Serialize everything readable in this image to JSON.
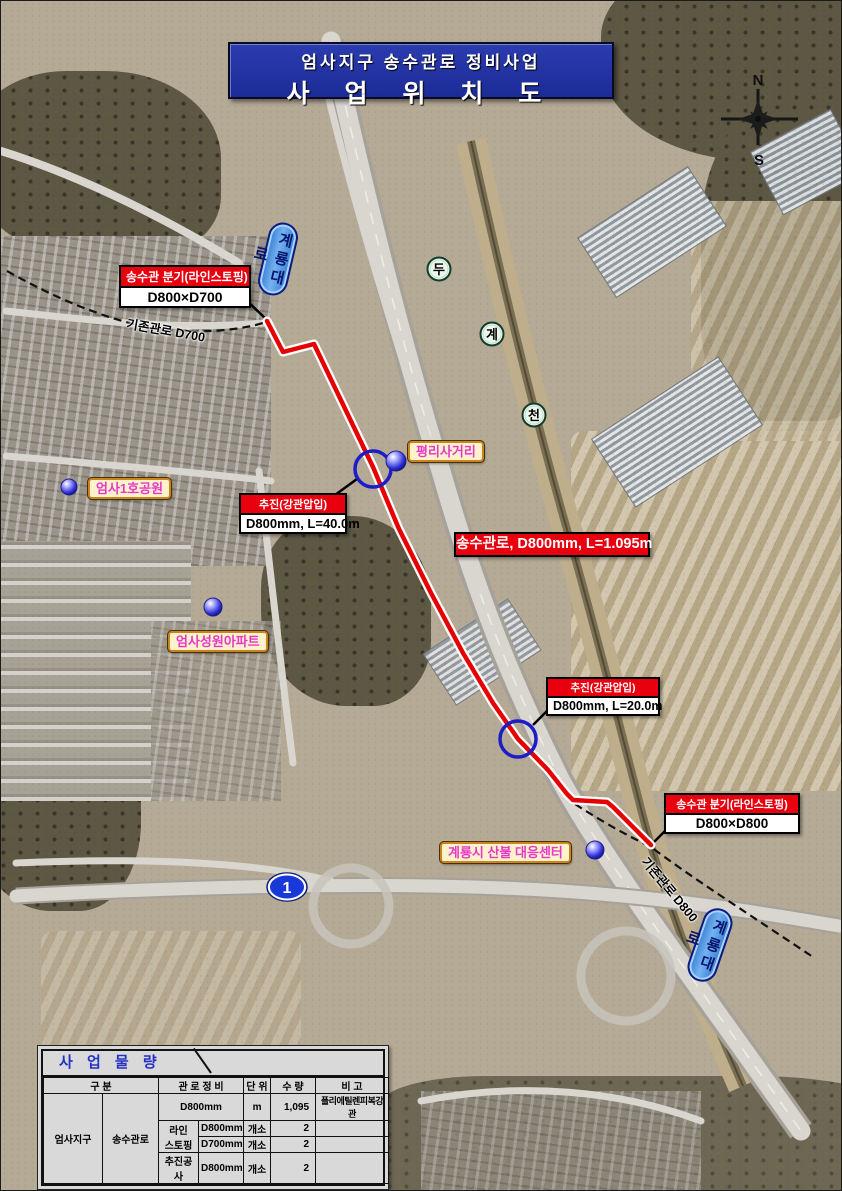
{
  "colors": {
    "title_bg": "#1c2b96",
    "callout_header_red": "#e8000f",
    "route_red": "#e60000",
    "place_label_text": "#e838cc",
    "place_label_bg": "#fdf2cc",
    "road_capsule_blue": "#4a93e0",
    "ring_blue": "#1d1dc8",
    "table_title_blue": "#2433c4"
  },
  "title": {
    "line1": "엄사지구 송수관로 정비사업",
    "line2": "사 업 위 치 도"
  },
  "compass": {
    "n": "N",
    "s": "S"
  },
  "road_labels": {
    "top_capsule": "계룡대로",
    "bottom_capsule": "계룡대로",
    "route_shield": "1"
  },
  "stream_labels": {
    "c1": "두",
    "c2": "계",
    "c3": "천"
  },
  "callouts": {
    "branch_top": {
      "header": "송수관 분기(라인스토핑)",
      "body": "D800×D700"
    },
    "jacking_top": {
      "header": "추진(강관압입)",
      "body": "D800mm, L=40.0m"
    },
    "mainline": {
      "text": "송수관로, D800mm, L=1.095m"
    },
    "jacking_bottom": {
      "header": "추진(강관압입)",
      "body": "D800mm, L=20.0m"
    },
    "branch_bottom": {
      "header": "송수관 분기(라인스토핑)",
      "body": "D800×D800"
    }
  },
  "place_labels": {
    "pyeongni_intersection": "평리사거리",
    "eomsa_park": "엄사1호공원",
    "eomsa_apartment": "엄사성원아파트",
    "fire_center": "계룡시 산불 대응센터"
  },
  "pipe_notes": {
    "existing_d700": "기존관로 D700",
    "existing_d800": "기존관로 D800"
  },
  "quantity_table": {
    "title": "사 업 물 량",
    "headers": {
      "category": "구  분",
      "pipework": "관 로 정 비",
      "unit": "단 위",
      "qty": "수 량",
      "note": "비 고"
    },
    "category": {
      "district": "엄사지구",
      "system": "송수관로"
    },
    "rows": {
      "main": {
        "spec": "D800mm",
        "unit": "m",
        "qty": "1,095",
        "note": "폴리에틸렌피복강관"
      },
      "linestopping_label": {
        "line1": "라인",
        "line2": "스토핑"
      },
      "ls_d800": {
        "spec": "D800mm",
        "unit": "개소",
        "qty": "2"
      },
      "ls_d700": {
        "spec": "D700mm",
        "unit": "개소",
        "qty": "2"
      },
      "jacking": {
        "label": "추진공사",
        "spec": "D800mm",
        "unit": "개소",
        "qty": "2"
      }
    }
  }
}
